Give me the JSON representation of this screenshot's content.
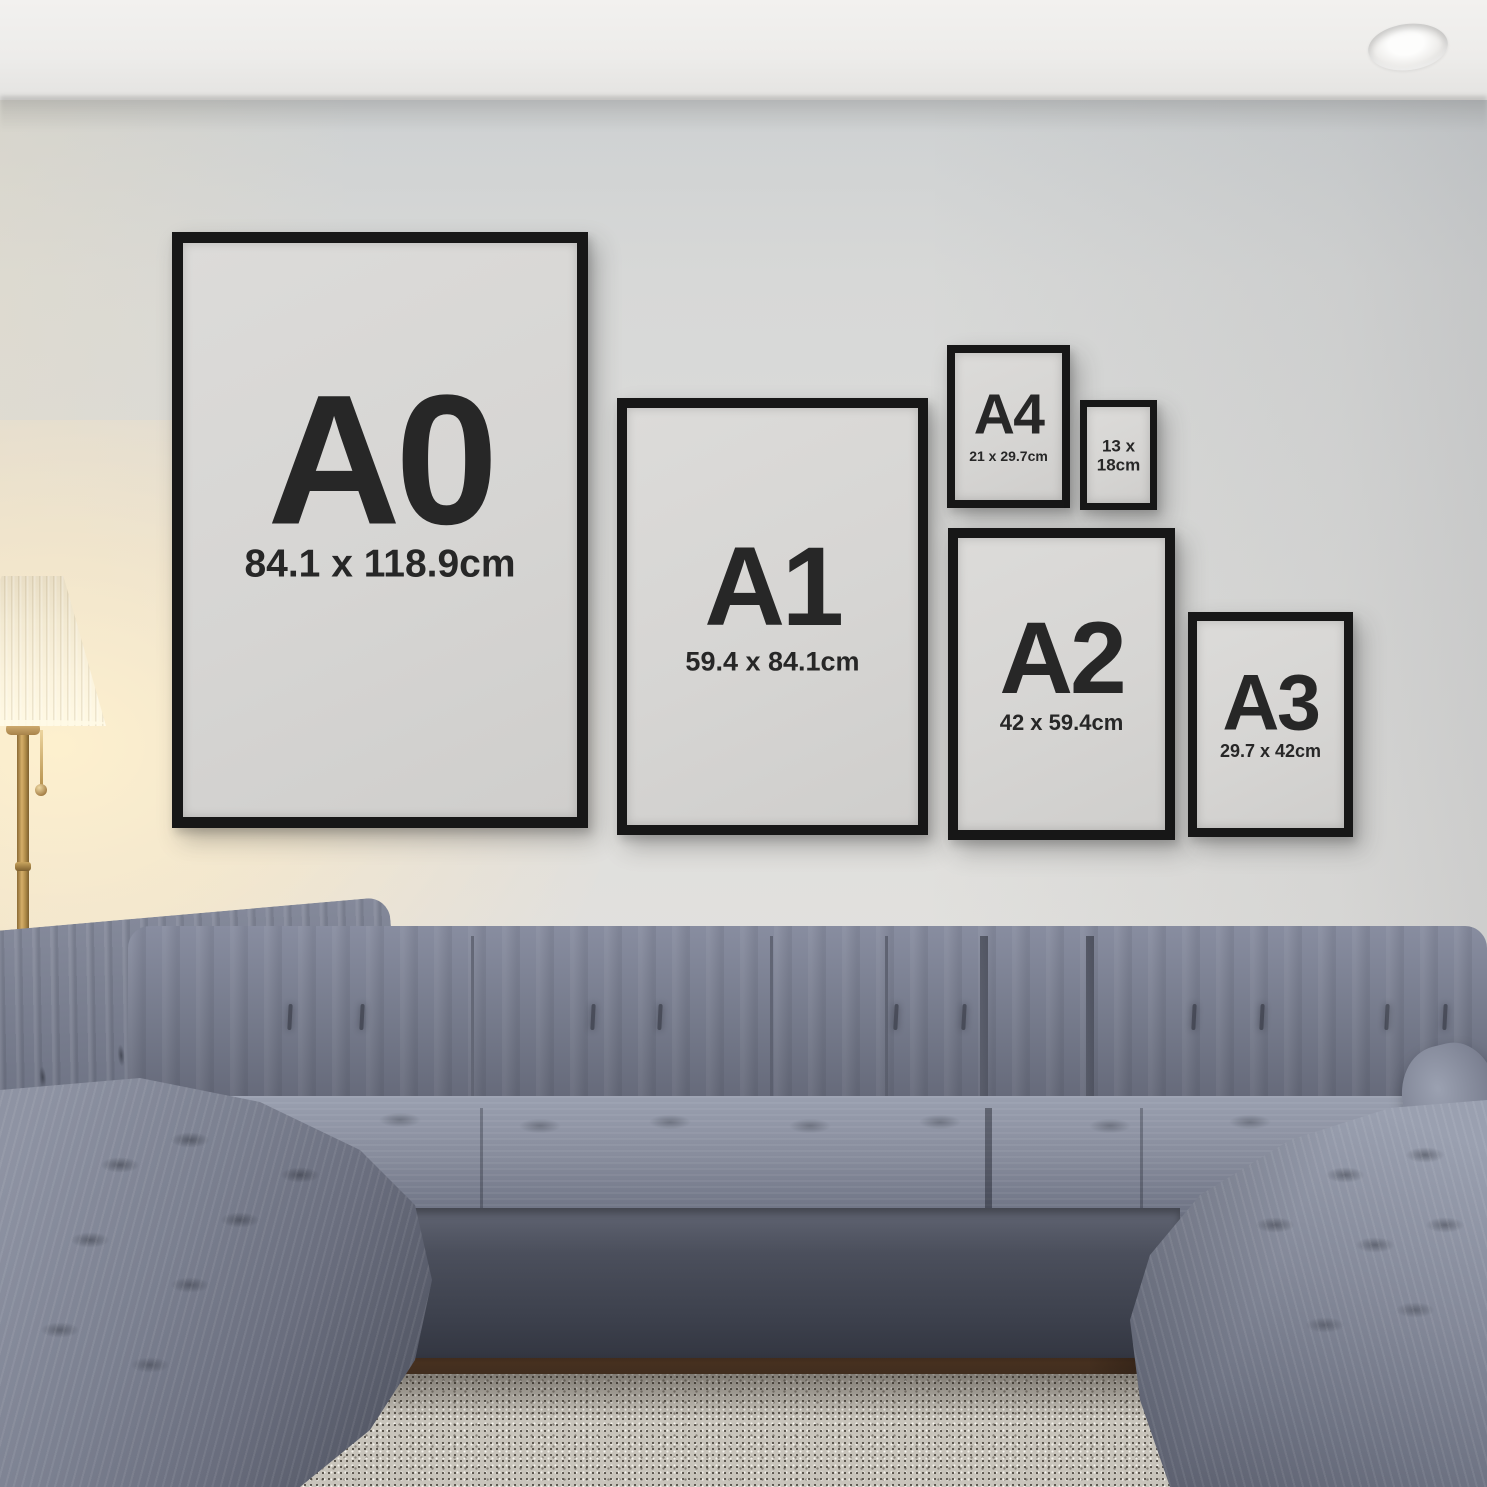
{
  "frames": [
    {
      "id": "a0",
      "label": "A0",
      "dimensions": "84.1 x 118.9cm"
    },
    {
      "id": "a1",
      "label": "A1",
      "dimensions": "59.4 x 84.1cm"
    },
    {
      "id": "a4",
      "label": "A4",
      "dimensions": "21 x 29.7cm"
    },
    {
      "id": "13x18",
      "line1": "13 x",
      "line2": "18cm"
    },
    {
      "id": "a2",
      "label": "A2",
      "dimensions": "42 x 59.4cm"
    },
    {
      "id": "a3",
      "label": "A3",
      "dimensions": "29.7 x 42cm"
    }
  ],
  "colors": {
    "wall": "#dcdcda",
    "ceiling": "#f0efed",
    "frame_border": "#171717",
    "poster_paper": "#d6d5d3",
    "label_text": "#272727",
    "sofa_mid": "#757a8b",
    "sofa_shadow": "#3c404c",
    "sofa_highlight": "#9aa0b0",
    "rug": "#c8c4bb",
    "wood_floor": "#46301f",
    "lamp_shade": "#f2e9d1",
    "lamp_glow": "#ffeccb",
    "brass": "#b8934f"
  }
}
